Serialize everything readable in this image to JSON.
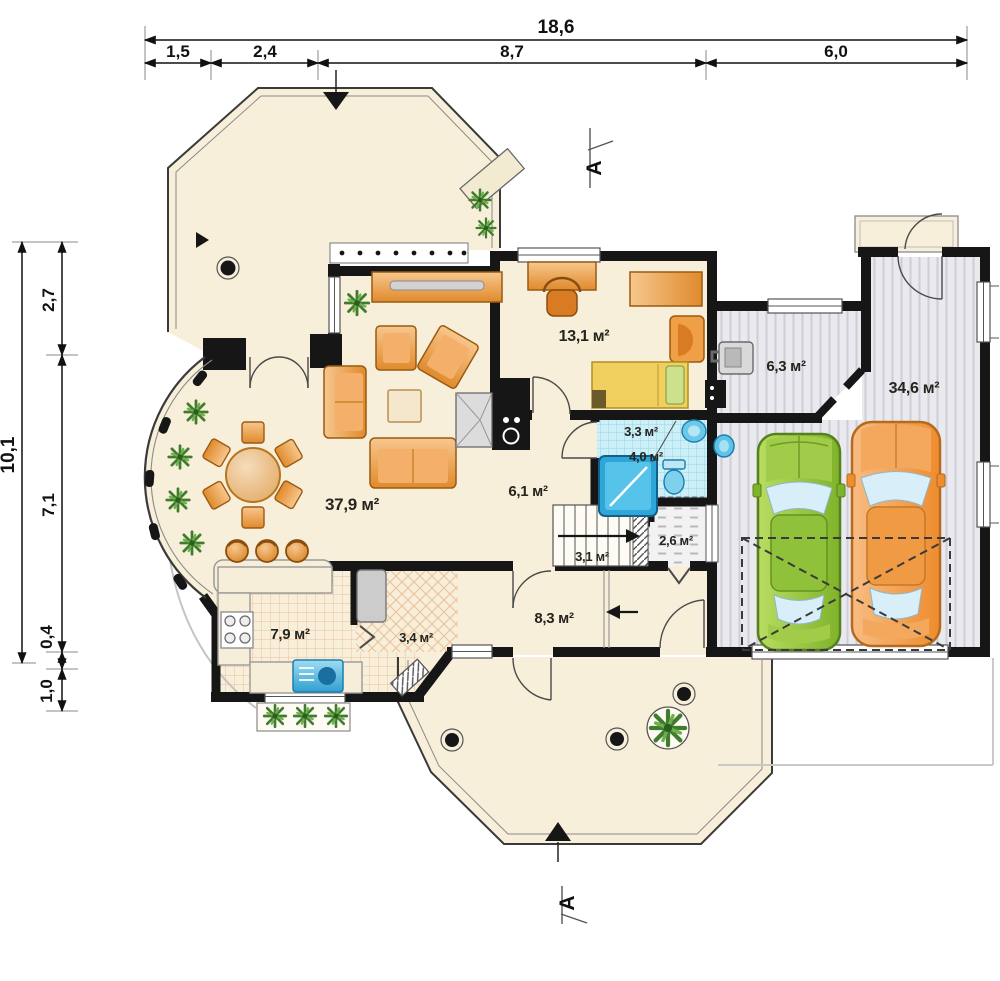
{
  "plan": {
    "title": "house-ground-floor-plan",
    "dims_top": {
      "total": "18,6",
      "seg1": "1,5",
      "seg2": "2,4",
      "seg3": "8,7",
      "seg4": "6,0"
    },
    "dims_left": {
      "total": "10,1",
      "seg1": "2,7",
      "seg2": "7,1",
      "seg3": "0,4",
      "seg4": "1,0"
    },
    "rooms": {
      "living": "37,9 м²",
      "bedroom": "13,1 м²",
      "utility": "6,3 м²",
      "garage": "34,6 м²",
      "wc": "3,3 м²",
      "bath": "4,0 м²",
      "hall": "6,1 м²",
      "stairs": "3,1 м²",
      "rear_hall": "2,6 м²",
      "corridor": "8,3 м²",
      "kitchen": "7,9 м²",
      "pantry": "3,4 м²"
    },
    "section": {
      "top": "A",
      "bottom": "A"
    },
    "colors": {
      "floor": "#f8efda",
      "wall": "#161616",
      "furniture": "#e9963c",
      "bath_fixture": "#39b4dd",
      "garage_floor": "#e9e9ee",
      "car_green": "#95c440",
      "car_orange": "#f09a4a",
      "plant": "#4e8a34"
    }
  }
}
